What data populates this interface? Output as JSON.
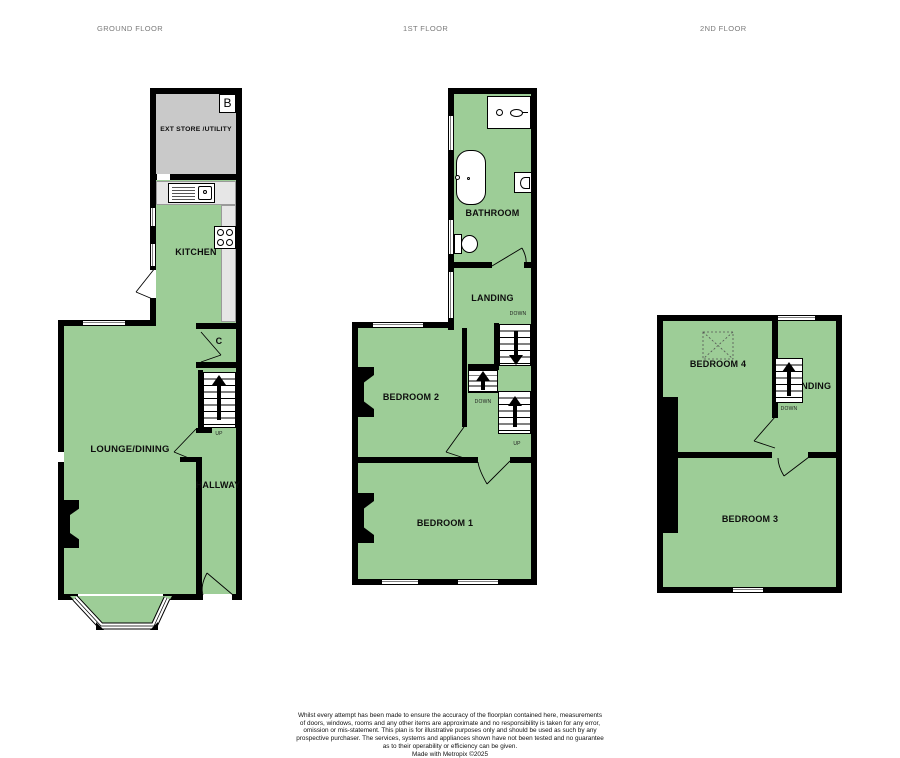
{
  "colors": {
    "room_fill": "#9dcd97",
    "store_fill": "#c9c9c9",
    "counter_fill": "#e6e6e6",
    "wall": "#000000",
    "floor_title": "#7a7a7a"
  },
  "floors": {
    "ground": {
      "title": "GROUND FLOOR",
      "rooms": {
        "ext_store": "EXT STORE /UTILITY",
        "boiler": "B",
        "kitchen": "KITCHEN",
        "cupboard": "C",
        "lounge": "LOUNGE/DINING",
        "hallway": "HALLWAY"
      },
      "stairs": {
        "up": "UP"
      }
    },
    "first": {
      "title": "1ST FLOOR",
      "rooms": {
        "bathroom": "BATHROOM",
        "landing": "LANDING",
        "bedroom2": "BEDROOM 2",
        "bedroom1": "BEDROOM 1"
      },
      "stairs": {
        "down_top": "DOWN",
        "down_mid": "DOWN",
        "up": "UP"
      }
    },
    "second": {
      "title": "2ND FLOOR",
      "rooms": {
        "bedroom4": "BEDROOM 4",
        "landing": "LANDING",
        "bedroom3": "BEDROOM 3"
      },
      "stairs": {
        "down": "DOWN"
      }
    }
  },
  "footer": {
    "lines": [
      "Whilst every attempt has been made to ensure the accuracy of the floorplan contained here, measurements",
      "of doors, windows, rooms and any other items are approximate and no responsibility is taken for any error,",
      "omission or mis-statement. This plan is for illustrative purposes only and should be used as such by any",
      "prospective purchaser. The services, systems and appliances shown have not been tested and no guarantee",
      "as to their operability or efficiency can be given."
    ],
    "credit": "Made with Metropix ©2025"
  }
}
